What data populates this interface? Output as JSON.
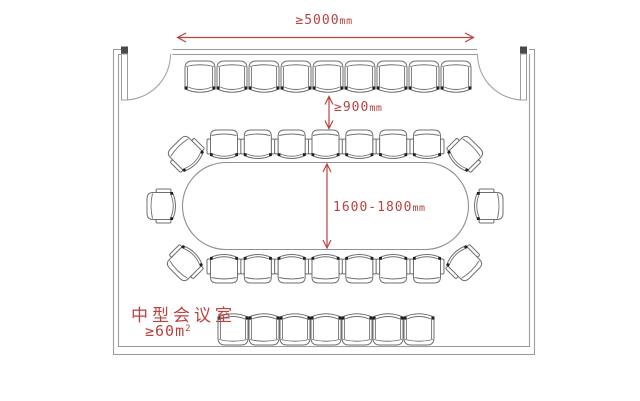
{
  "colors": {
    "dimension_red": "#b8433f",
    "wall_gray": "#9d9d9d",
    "furniture_gray": "#6f6f6f",
    "table_gray": "#8f8f8f"
  },
  "labels": {
    "room_width": {
      "value": "≥5000",
      "unit": "mm"
    },
    "aisle_clearance": {
      "value": "≥900",
      "unit": "mm"
    },
    "table_width": {
      "value": "1600-1800",
      "unit": "mm"
    },
    "room_type": "中型会议室",
    "room_area": {
      "value": "≥60m",
      "sup": "2"
    }
  },
  "seating": {
    "wall_row_top": 9,
    "table_row_top": 7,
    "table_row_bottom": 7,
    "table_end_left": 1,
    "table_end_right": 1,
    "table_corners": 4,
    "back_row_bottom": 7
  },
  "fixtures": {
    "doors": 2,
    "table": "oval-conference-table"
  }
}
